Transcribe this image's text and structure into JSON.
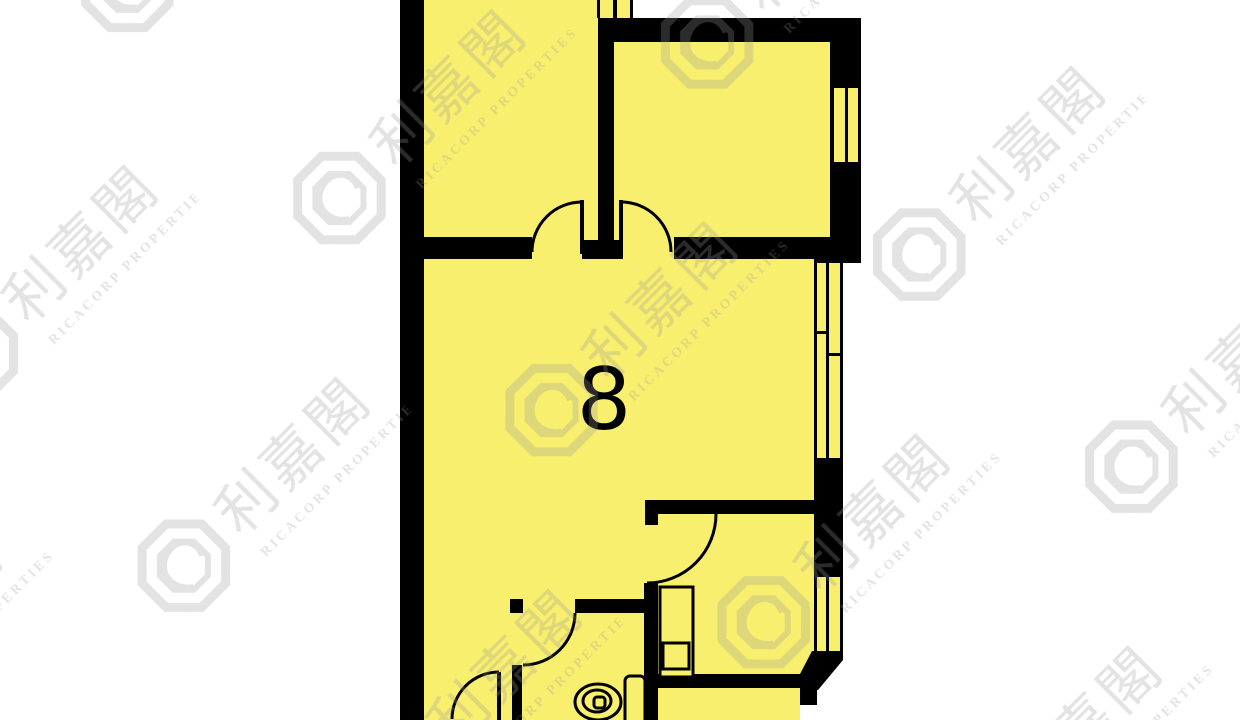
{
  "floorplan": {
    "unit_label": "8",
    "colors": {
      "room_fill": "#F8EF6E",
      "wall": "#000000",
      "background": "#FFFFFF",
      "watermark": "#9B9B9B"
    }
  },
  "watermark": {
    "brand_cjk": "利嘉閣",
    "brand_en": "RICACORP PROPERTIES"
  }
}
